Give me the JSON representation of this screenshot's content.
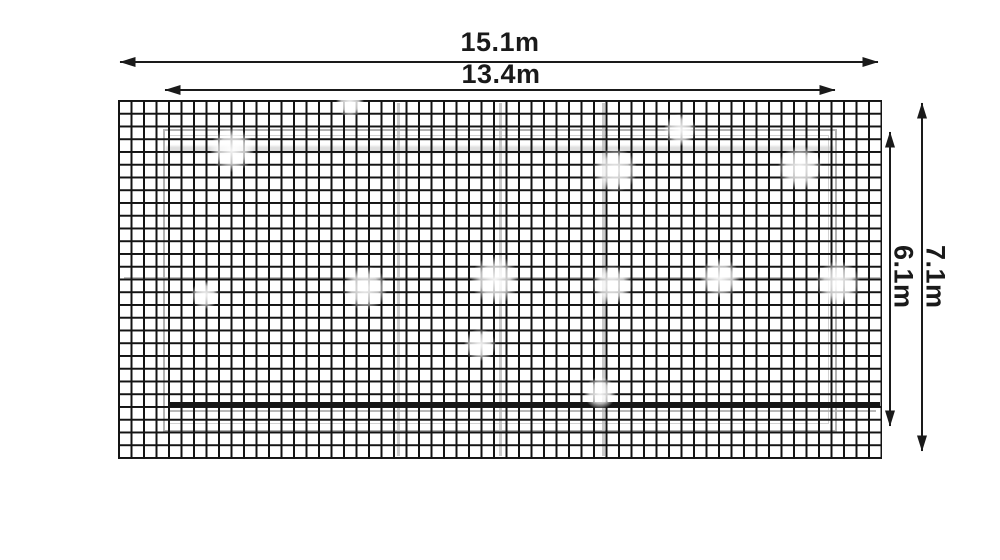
{
  "diagram": {
    "kind": "dimensioned-mesh-panel-drawing",
    "unit": "m",
    "labels": {
      "outer_width": "15.1m",
      "inner_width": "13.4m",
      "outer_height": "7.1m",
      "inner_height": "6.1m"
    },
    "values": {
      "outer_width_m": 15.1,
      "inner_width_m": 13.4,
      "outer_height_m": 7.1,
      "inner_height_m": 6.1
    },
    "colors": {
      "ink": "#1a1a1a",
      "mesh_line": "#141414",
      "ghost_line": "#b4b4b4",
      "background": "#ffffff"
    }
  }
}
